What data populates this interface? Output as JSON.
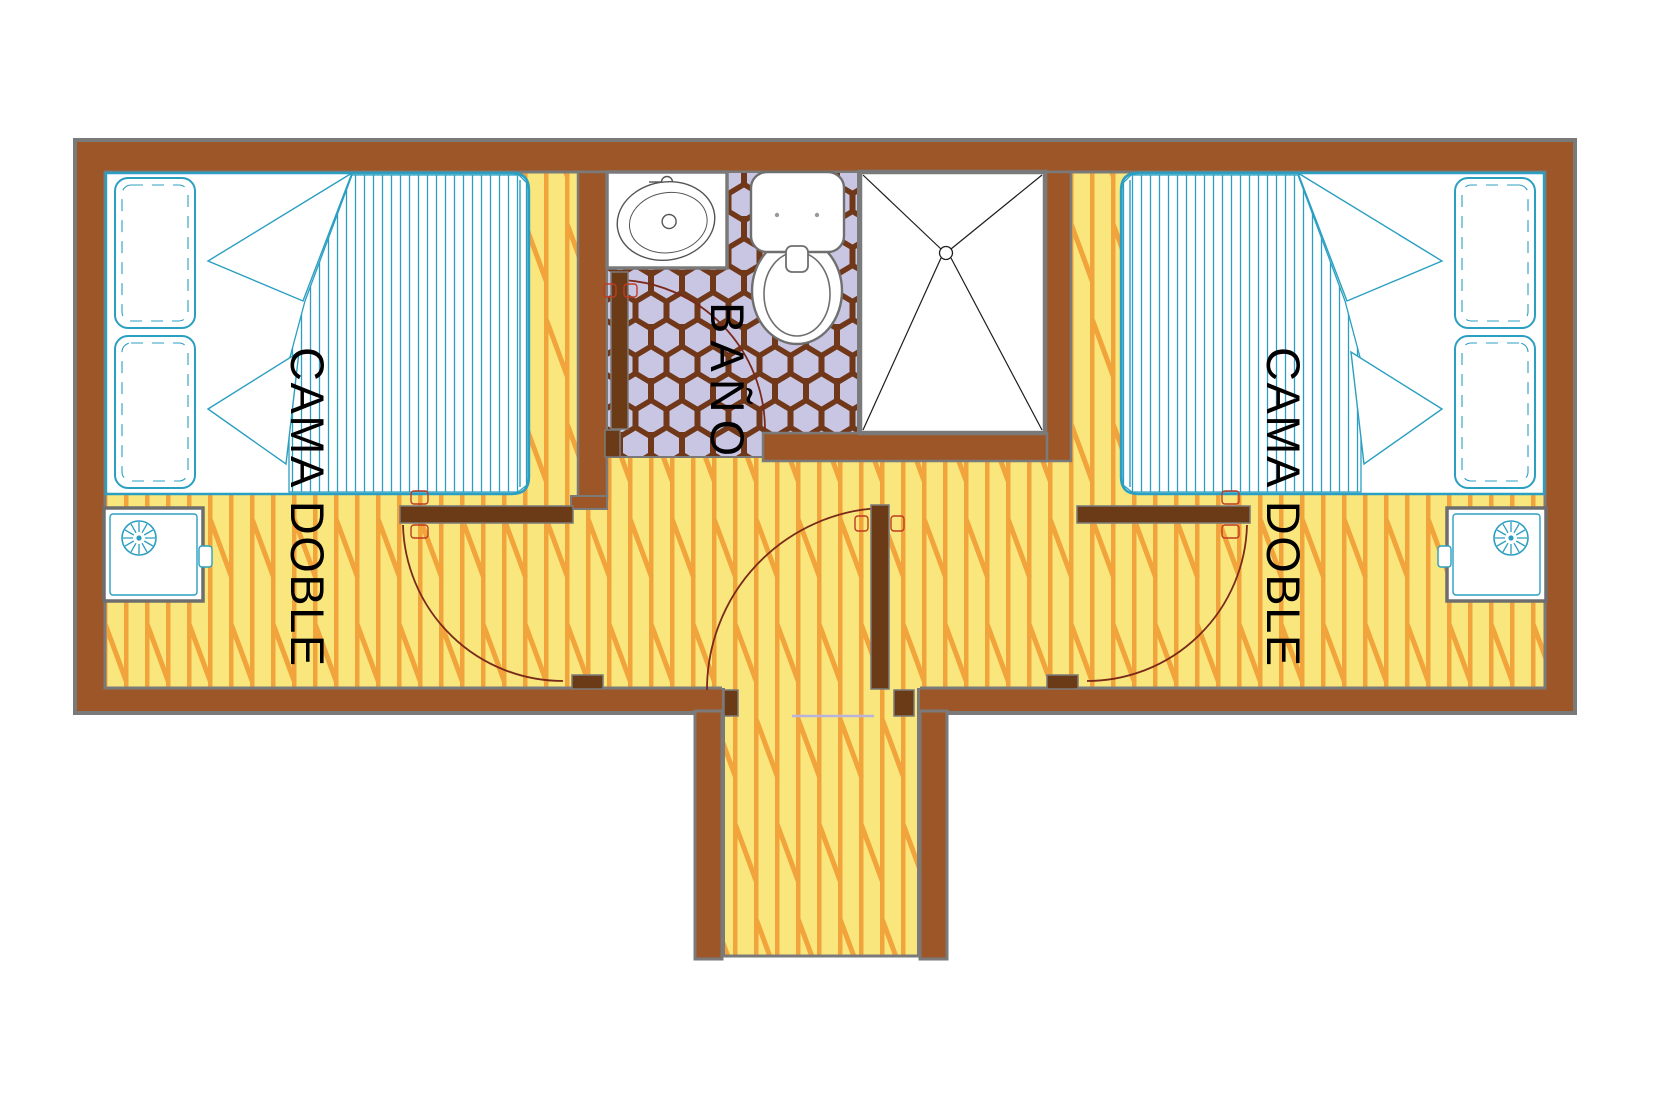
{
  "plan": {
    "kind": "cabin floor plan",
    "rooms": [
      {
        "id": "left_bedroom",
        "label": "CAMA DOBLE"
      },
      {
        "id": "bathroom",
        "label": "BAÑO"
      },
      {
        "id": "right_bedroom",
        "label": "CAMA DOBLE"
      }
    ]
  },
  "labels": {
    "left_bedroom": "CAMA DOBLE",
    "bathroom": "BAÑO",
    "right_bedroom": "CAMA DOBLE"
  },
  "fixtures": {
    "left_bedroom": [
      "double-bed",
      "pillows",
      "folded-sheet",
      "nightstand",
      "lamp",
      "swing-door"
    ],
    "bathroom": [
      "sink-counter",
      "sink",
      "faucet",
      "toilet",
      "shower",
      "shower-drain",
      "swing-door",
      "hex-tile-floor"
    ],
    "right_bedroom": [
      "double-bed",
      "pillows",
      "folded-sheet",
      "nightstand",
      "lamp",
      "swing-door"
    ],
    "corridor": [
      "entry-door",
      "entry-threshold",
      "wood-plank-floor"
    ]
  },
  "colors": {
    "wall_brown": "#9d5628",
    "door_brown": "#6b3a16",
    "outline_gray": "#7a7a7a",
    "floor_yellow": "#f9e77d",
    "floor_stripe_orange": "#f2a43c",
    "tile_lavender": "#c9c6e4",
    "tile_grout_brown": "#703718",
    "furniture_teal": "#2b9fc1",
    "door_swing_red": "#7a291a",
    "handle_red": "#c03a23",
    "label_text": "#000000"
  }
}
